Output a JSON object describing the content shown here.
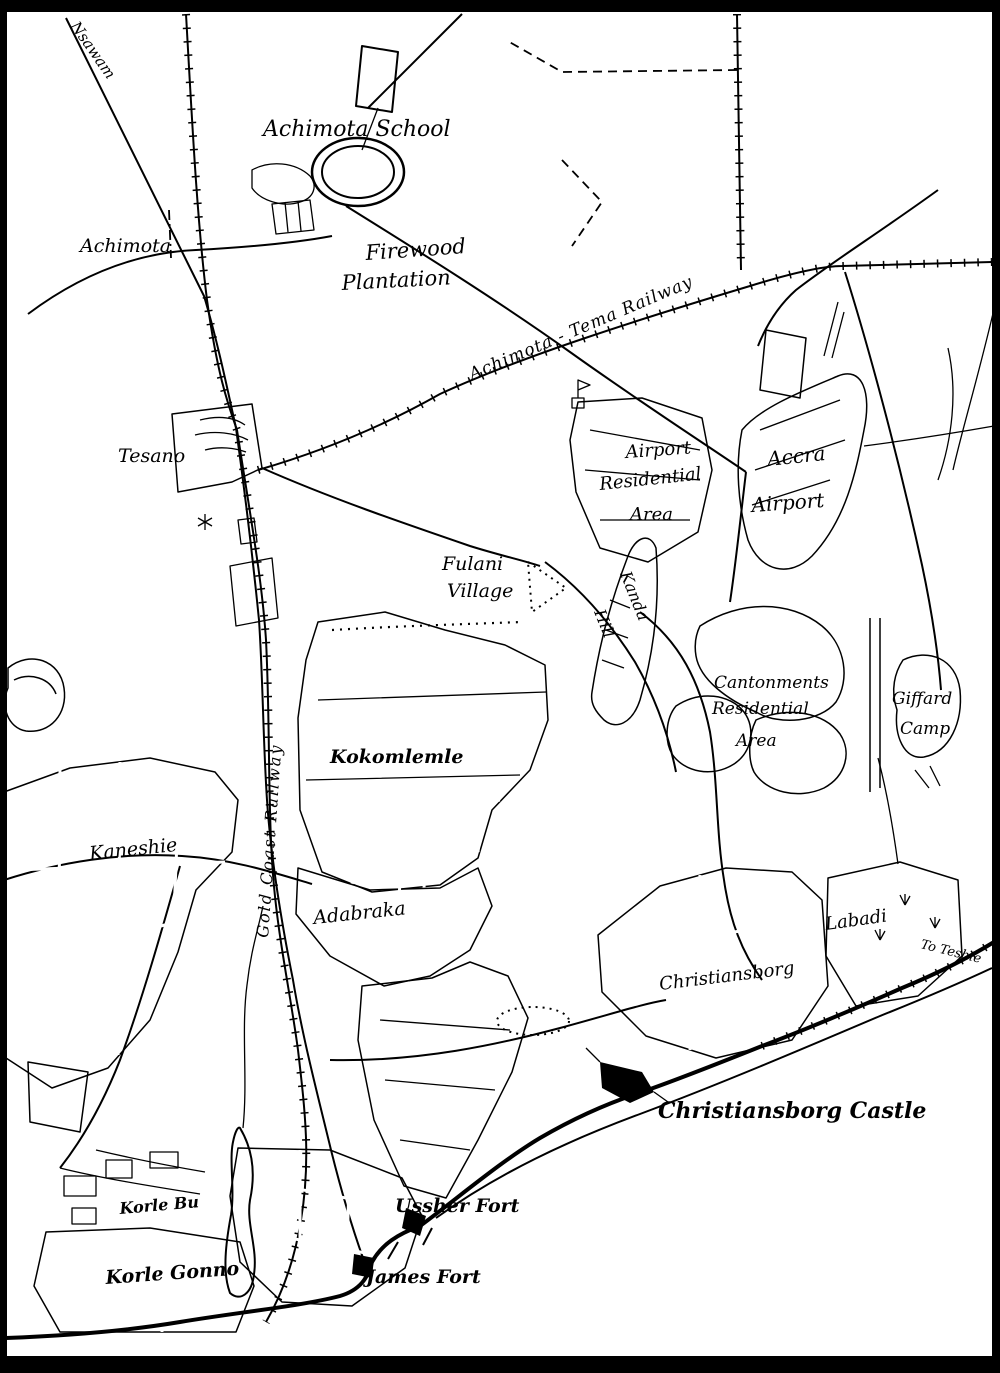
{
  "map": {
    "colors": {
      "ink": "#000000",
      "paper": "#ffffff"
    },
    "labels": {
      "nsawam": "Nsawam",
      "achimota": "Achimota",
      "achimota_school": "Achimota School",
      "firewood_line1": "Firewood",
      "firewood_line2": "Plantation",
      "achimota_tema_railway": "Achimota - Tema Railway",
      "tesano": "Tesano",
      "airport_res_line1": "Airport",
      "airport_res_line2": "Residential",
      "airport_res_line3": "Area",
      "accra_airport_line1": "Accra",
      "accra_airport_line2": "Airport",
      "fulani_line1": "Fulani",
      "fulani_line2": "Village",
      "kanda_line1": "Kanda",
      "kanda_line2": "Hill",
      "kokomlemle": "Kokomlemle",
      "kaneshie": "Kaneshie",
      "gold_coast_railway": "Gold Coast Railway",
      "adabraka": "Adabraka",
      "cantonments_line1": "Cantonments",
      "cantonments_line2": "Residential",
      "cantonments_line3": "Area",
      "giffard_line1": "Giffard",
      "giffard_line2": "Camp",
      "christiansborg": "Christiansborg",
      "labadi": "Labadi",
      "to_teshie": "To Teshie",
      "christiansborg_castle": "Christiansborg Castle",
      "ussher_fort": "Ussher Fort",
      "james_fort": "James Fort",
      "korle_bu": "Korle Bu",
      "korle_gonno": "Korle Gonno"
    }
  }
}
